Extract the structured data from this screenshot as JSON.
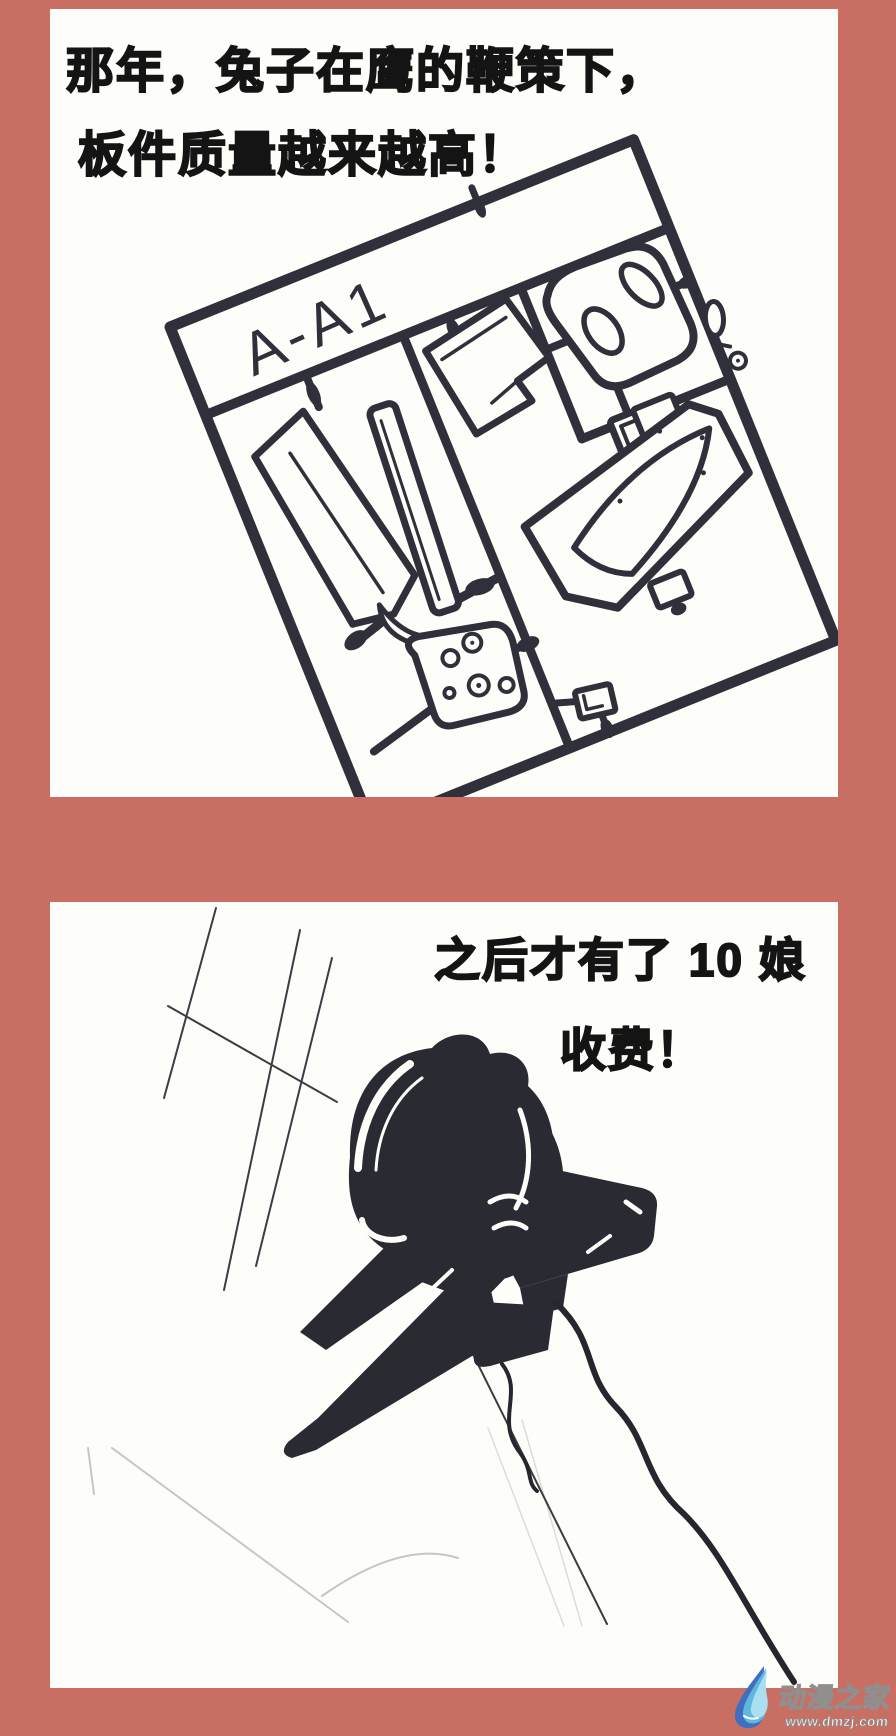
{
  "theme": {
    "background_color": "#c96e63",
    "panel_color": "#fdfdfa",
    "ink_color": "#141414",
    "line_color": "#30303a",
    "silhouette_color": "#2a2a33",
    "watermark_text_color": "#ffffff",
    "watermark_outline_color": "#8f8f8f",
    "logo_blue_light": "#a9dff1",
    "logo_blue_mid": "#5fb7dd",
    "logo_blue_dark": "#3f6fc0"
  },
  "panel1": {
    "caption_line1": "那年，兔子在鹰的鞭策下，",
    "caption_line2": "板件质量越来越高！",
    "sprue_label": "A-A1"
  },
  "panel2": {
    "caption_line1": "之后才有了 10 娘",
    "caption_line2": "收费！"
  },
  "watermark": {
    "site_name": "动漫之家",
    "site_url": "www.dmzj.com"
  }
}
